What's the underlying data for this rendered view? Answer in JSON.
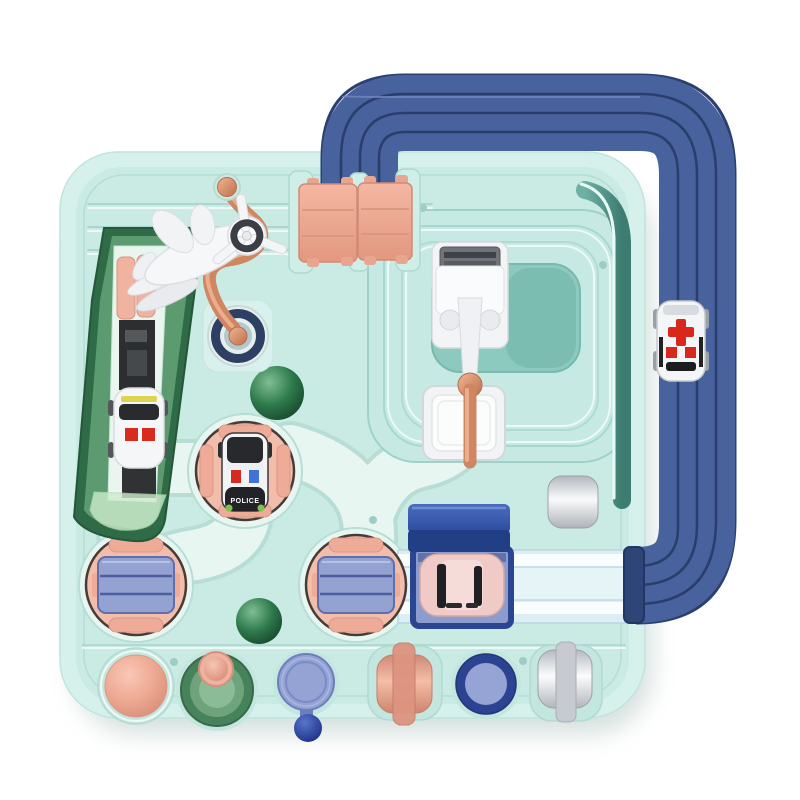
{
  "scene": {
    "type": "product-photo",
    "subject": "children's race track adventure toy board, top view",
    "background": "#ffffff"
  },
  "labels": {
    "police_car": "POLICE"
  },
  "colors": {
    "board_rim": "#d6f1ec",
    "board_face": "#c9ebe4",
    "road": "#e8f6f2",
    "loop_hole": "#8cc9bf",
    "navy_track": "#47629c",
    "navy_track_groove": "#263b66",
    "salmon_pink": "#f3bdac",
    "periwinkle": "#93a2d0",
    "copper_lever": "#cf8663",
    "ramp_green_dark": "#2e6b46",
    "ramp_green_light": "#5c9a6f",
    "ball_green": "#2e7a4c",
    "ambulance_red": "#d8281c",
    "canopy_blue": "#3a5cb0",
    "police_roof_black": "#28292d",
    "white_plastic": "#f4f5f7"
  },
  "elements": [
    "elevated-navy-track-loop",
    "ambulance-car",
    "game-board",
    "toy-plane",
    "copper-lever",
    "navy-dial-knob",
    "pink-flip-bridge",
    "crossing-gate",
    "gate-tray",
    "teal-loop-track",
    "green-slide-ramp",
    "white-car",
    "police-car",
    "police-turntable",
    "launcher-turntable-left",
    "launcher-turntable-right",
    "green-ball-upper",
    "green-ball-lower",
    "pink-car",
    "car-bay-canopy",
    "silver-roller",
    "exit-track",
    "pink-dome-button",
    "green-funnel-button",
    "disc-pull-button",
    "pink-roller-button",
    "blue-ring-button",
    "white-roller-button"
  ]
}
